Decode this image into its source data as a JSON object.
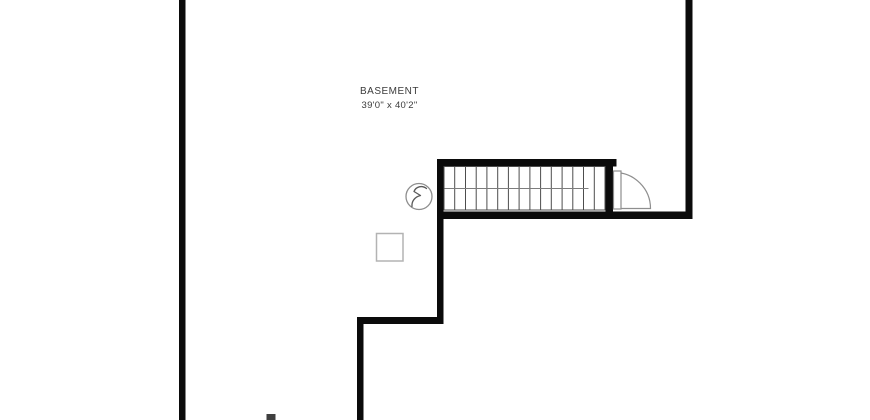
{
  "floorplan": {
    "room": {
      "name": "BASEMENT",
      "dimensions": "39'0\" x 40'2\""
    },
    "symbols": [
      {
        "name": "staircase",
        "treads": 15
      },
      {
        "name": "door-swing"
      },
      {
        "name": "electrical-bolt-icon"
      },
      {
        "name": "column-post"
      }
    ],
    "colors": {
      "wall": "#0b0b0b",
      "stub": "#3f3f3f",
      "stair_stroke": "#4d4d4d",
      "rail_stroke": "#7d7d7d",
      "door_stroke": "#8e8e8e",
      "symbol_stroke": "#8e8e8e",
      "bolt_stroke": "#5a5a5a",
      "column_stroke": "#b3b3b3",
      "text": "#3b3b3b",
      "background": "#ffffff"
    }
  }
}
